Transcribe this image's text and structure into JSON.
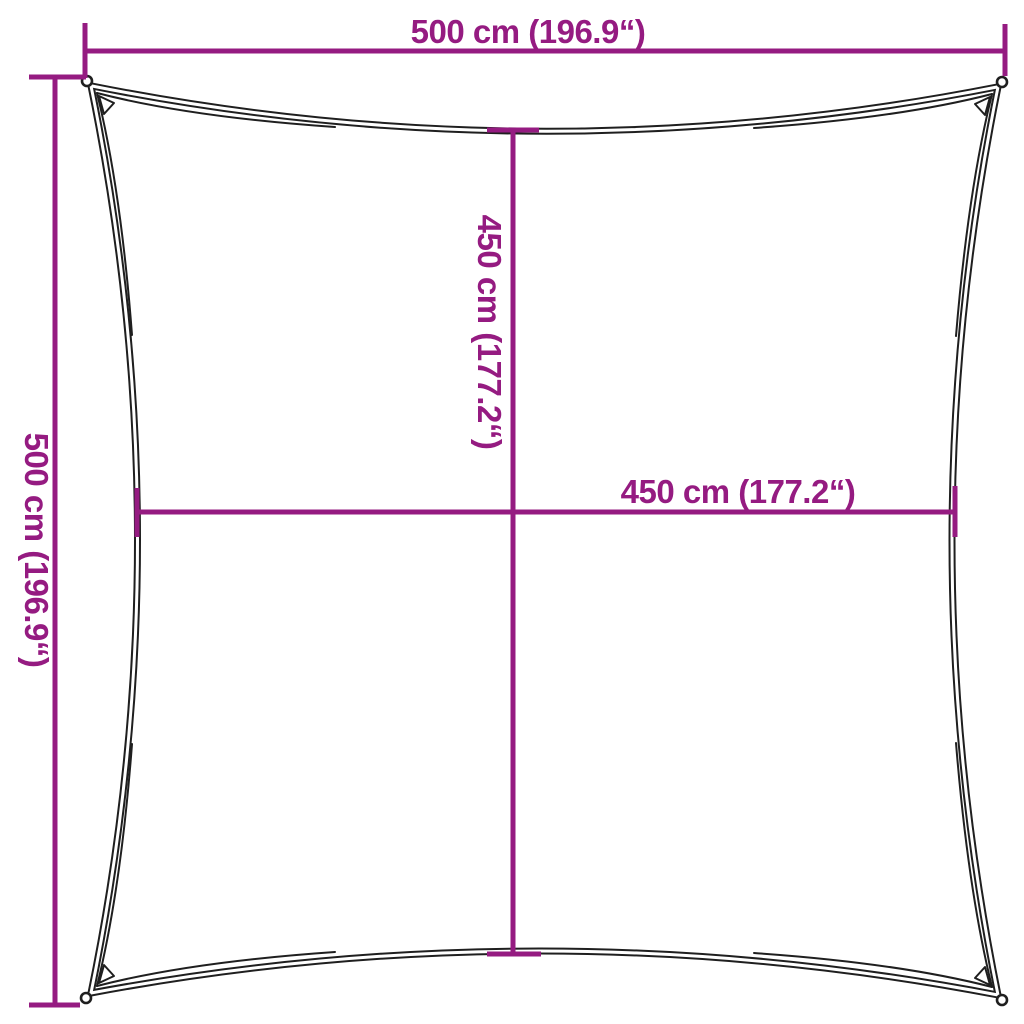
{
  "canvas": {
    "width_px": 1024,
    "height_px": 1024,
    "background": "#ffffff"
  },
  "style": {
    "accent_color": "#951b81",
    "outline_color": "#1f1f1f"
  },
  "shape": {
    "kind": "square-shade-sail",
    "edges": "concave",
    "corner_grommets": 4
  },
  "measurements": {
    "top_width": {
      "text": "500 cm (196.9“)",
      "cm": 500,
      "inches": 196.9
    },
    "left_height": {
      "text": "500 cm (196.9“)",
      "cm": 500,
      "inches": 196.9
    },
    "inner_vertical": {
      "text": "450 cm (177.2“)",
      "cm": 450,
      "inches": 177.2
    },
    "inner_horizontal": {
      "text": "450 cm (177.2“)",
      "cm": 450,
      "inches": 177.2
    }
  }
}
